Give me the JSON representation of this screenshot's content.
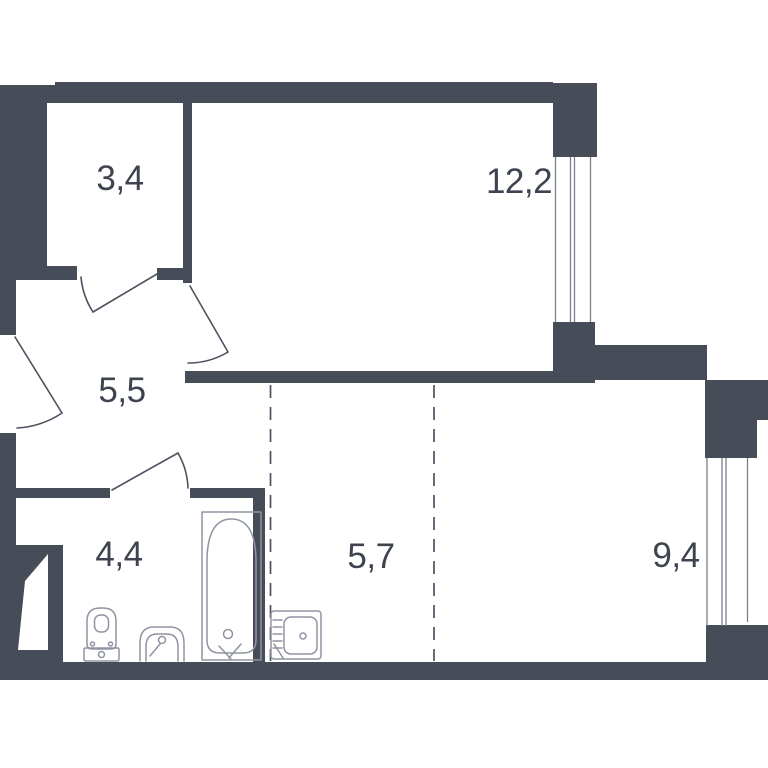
{
  "colors": {
    "bg": "#ffffff",
    "wall": "#474c59",
    "line": "#4d5260",
    "winline": "#7a7f8c",
    "fixture": "#9094a2",
    "text": "#3e4350"
  },
  "rooms": [
    {
      "id": "room-1",
      "area": "3,4"
    },
    {
      "id": "room-2",
      "area": "12,2"
    },
    {
      "id": "room-3",
      "area": "5,5"
    },
    {
      "id": "room-4",
      "area": "4,4"
    },
    {
      "id": "room-5",
      "area": "5,7"
    },
    {
      "id": "room-6",
      "area": "9,4"
    }
  ]
}
